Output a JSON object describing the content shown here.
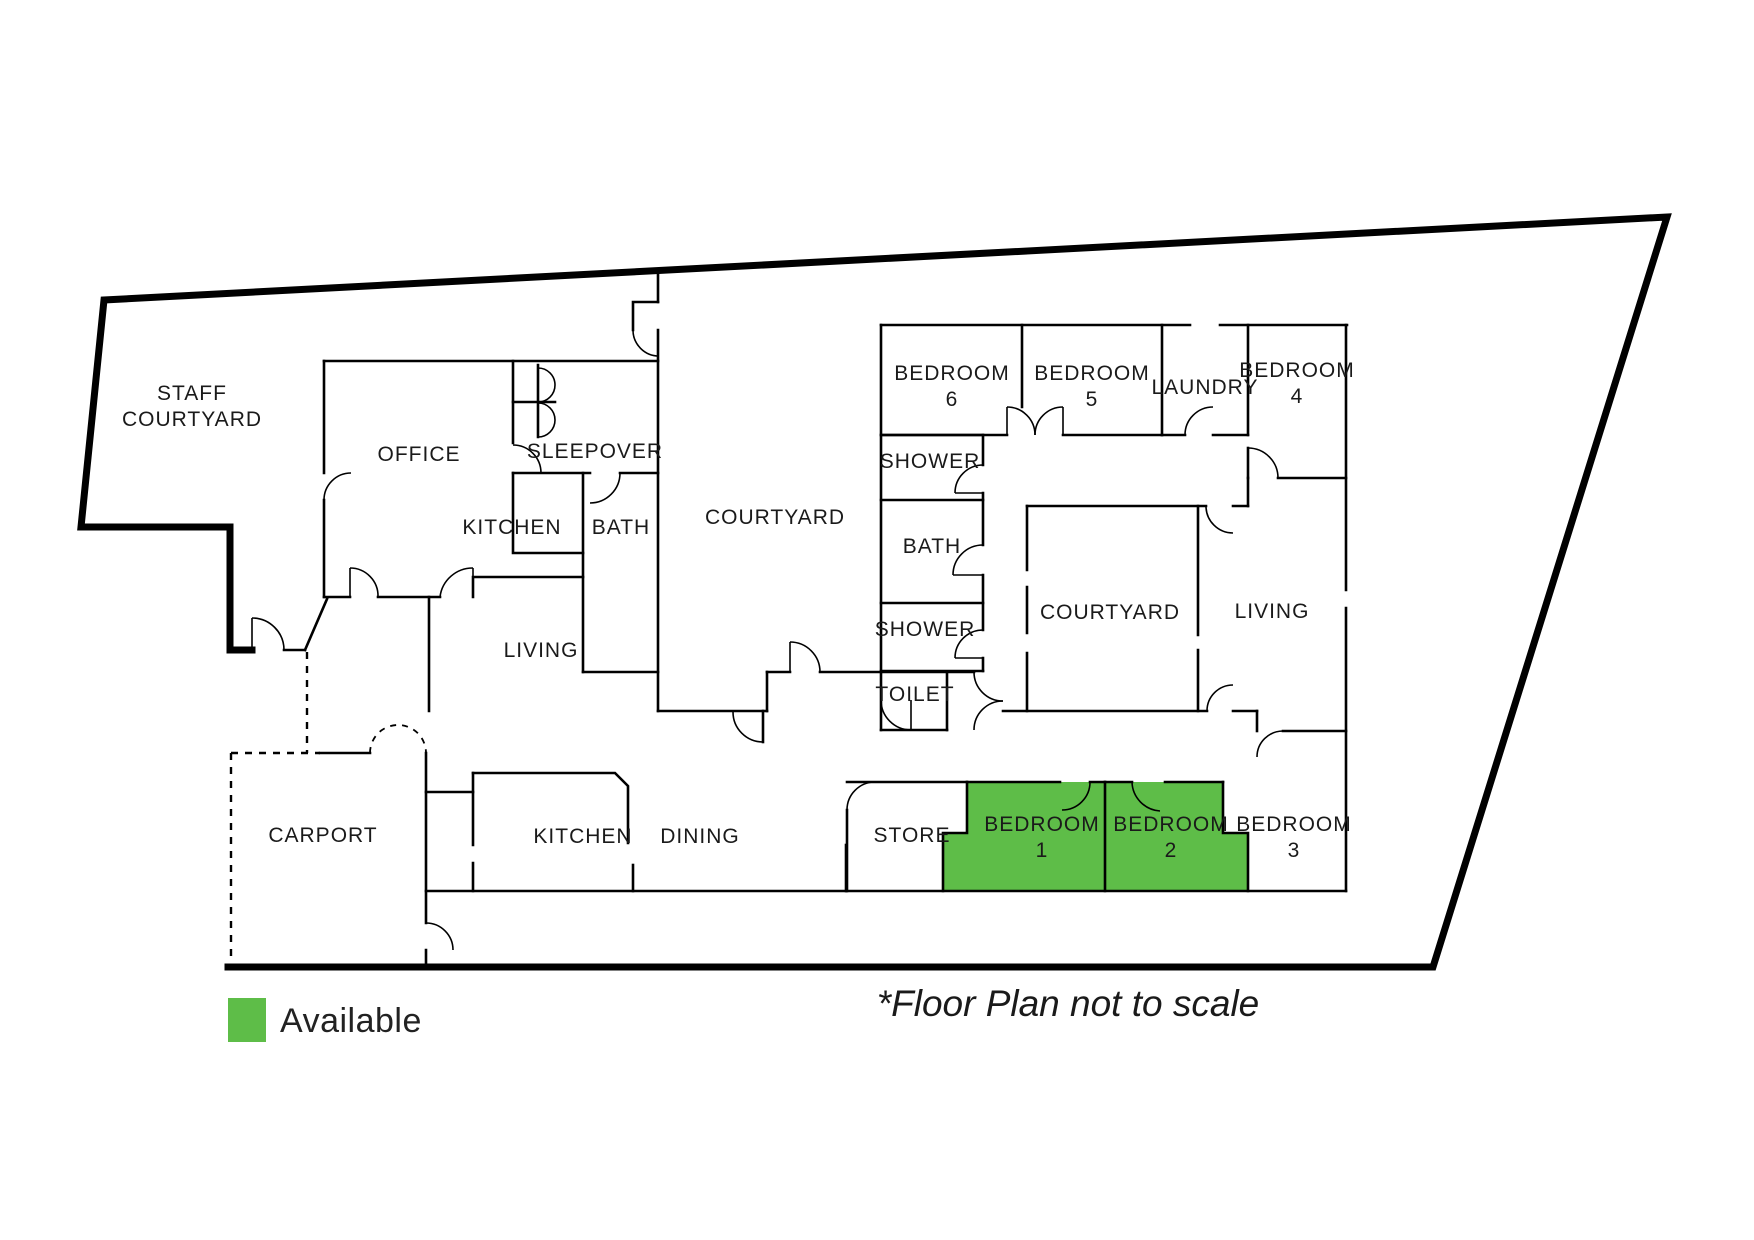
{
  "title": "Floor plan",
  "colors": {
    "available_green": "#5EBD48",
    "wall": "#000000",
    "text": "#1A1A1A"
  },
  "legend": {
    "swatch_label": "Available"
  },
  "note": "*Floor Plan not to scale",
  "rooms": [
    {
      "id": "staff-courtyard",
      "lines": [
        "STAFF",
        "COURTYARD"
      ],
      "x": 192,
      "y": 400,
      "highlighted": false
    },
    {
      "id": "office",
      "lines": [
        "OFFICE"
      ],
      "x": 419,
      "y": 461,
      "highlighted": false
    },
    {
      "id": "sleepover",
      "lines": [
        "SLEEPOVER"
      ],
      "x": 595,
      "y": 458,
      "highlighted": false
    },
    {
      "id": "kitchen-top",
      "lines": [
        "KITCHEN"
      ],
      "x": 512,
      "y": 534,
      "highlighted": false
    },
    {
      "id": "bath-top",
      "lines": [
        "BATH"
      ],
      "x": 621,
      "y": 534,
      "highlighted": false
    },
    {
      "id": "courtyard-mid",
      "lines": [
        "COURTYARD"
      ],
      "x": 775,
      "y": 524,
      "highlighted": false
    },
    {
      "id": "bedroom-6",
      "lines": [
        "BEDROOM",
        "6"
      ],
      "x": 952,
      "y": 380,
      "highlighted": false
    },
    {
      "id": "bedroom-5",
      "lines": [
        "BEDROOM",
        "5"
      ],
      "x": 1092,
      "y": 380,
      "highlighted": false
    },
    {
      "id": "laundry",
      "lines": [
        "LAUNDRY"
      ],
      "x": 1205,
      "y": 394,
      "highlighted": false
    },
    {
      "id": "bedroom-4",
      "lines": [
        "BEDROOM",
        "4"
      ],
      "x": 1297,
      "y": 377,
      "highlighted": false
    },
    {
      "id": "shower-1",
      "lines": [
        "SHOWER"
      ],
      "x": 930,
      "y": 468,
      "highlighted": false
    },
    {
      "id": "bath-right",
      "lines": [
        "BATH"
      ],
      "x": 932,
      "y": 553,
      "highlighted": false
    },
    {
      "id": "shower-2",
      "lines": [
        "SHOWER"
      ],
      "x": 925,
      "y": 636,
      "highlighted": false
    },
    {
      "id": "toilet",
      "lines": [
        "TOILET"
      ],
      "x": 915,
      "y": 701,
      "highlighted": false
    },
    {
      "id": "courtyard-inner",
      "lines": [
        "COURTYARD"
      ],
      "x": 1110,
      "y": 619,
      "highlighted": false
    },
    {
      "id": "living-right",
      "lines": [
        "LIVING"
      ],
      "x": 1272,
      "y": 618,
      "highlighted": false
    },
    {
      "id": "living-left",
      "lines": [
        "LIVING"
      ],
      "x": 541,
      "y": 657,
      "highlighted": false
    },
    {
      "id": "carport",
      "lines": [
        "CARPORT"
      ],
      "x": 323,
      "y": 842,
      "highlighted": false
    },
    {
      "id": "kitchen-2",
      "lines": [
        "KITCHEN"
      ],
      "x": 583,
      "y": 843,
      "highlighted": false
    },
    {
      "id": "dining",
      "lines": [
        "DINING"
      ],
      "x": 700,
      "y": 843,
      "highlighted": false
    },
    {
      "id": "store",
      "lines": [
        "STORE"
      ],
      "x": 912,
      "y": 842,
      "highlighted": false
    },
    {
      "id": "bedroom-1",
      "lines": [
        "BEDROOM",
        "1"
      ],
      "x": 1042,
      "y": 831,
      "highlighted": true
    },
    {
      "id": "bedroom-2",
      "lines": [
        "BEDROOM",
        "2"
      ],
      "x": 1171,
      "y": 831,
      "highlighted": true
    },
    {
      "id": "bedroom-3",
      "lines": [
        "BEDROOM",
        "3"
      ],
      "x": 1294,
      "y": 831,
      "highlighted": false
    }
  ]
}
